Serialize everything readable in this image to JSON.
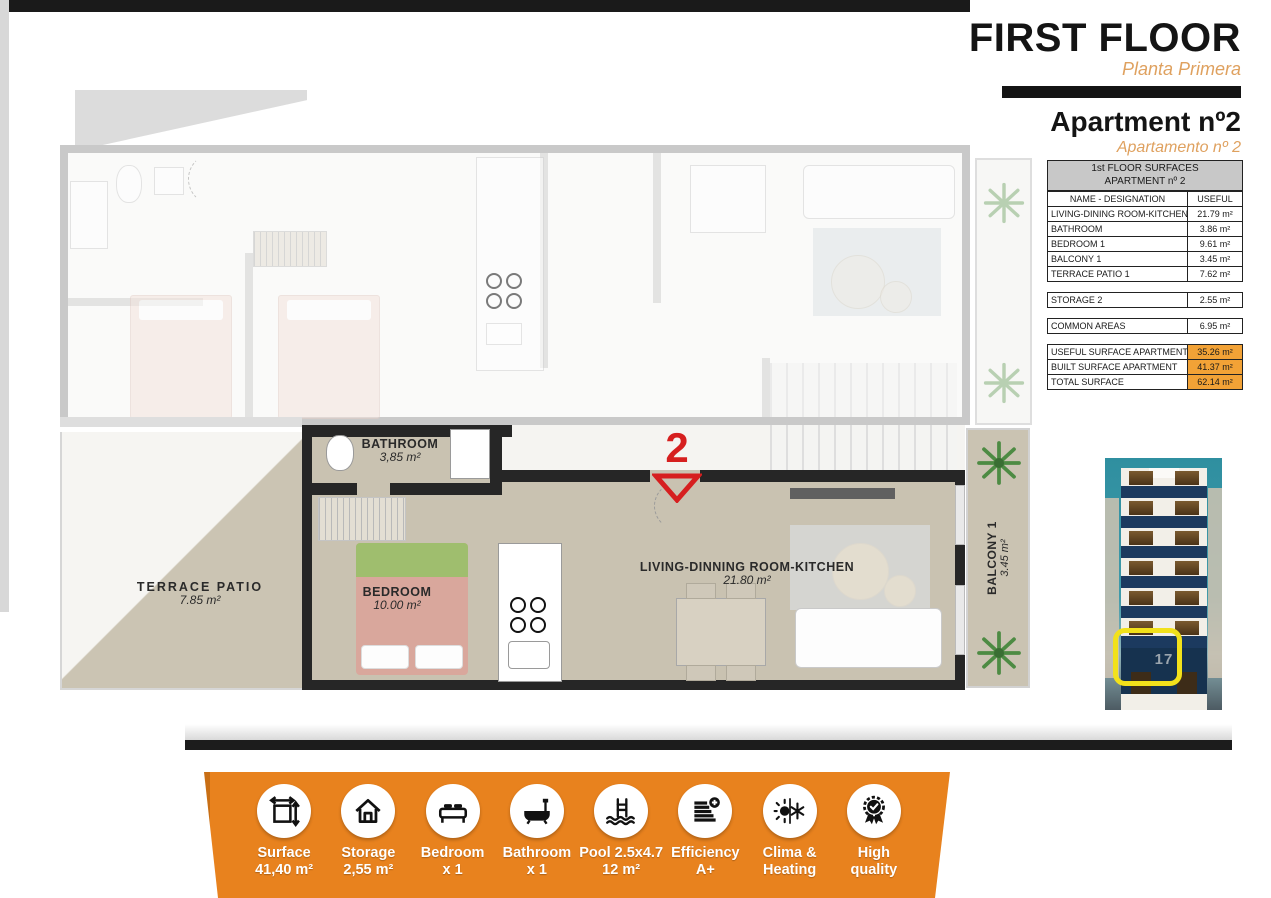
{
  "header": {
    "title": "FIRST FLOOR",
    "subtitle": "Planta Primera",
    "apartment_title": "Apartment nº2",
    "apartment_subtitle": "Apartamento nº 2"
  },
  "surfaces_table": {
    "title_line1": "1st FLOOR SURFACES",
    "title_line2": "APARTMENT nº 2",
    "col_name": "NAME - DESIGNATION",
    "col_useful": "USEFUL",
    "rows": [
      {
        "name": "LIVING-DINING ROOM-KITCHEN",
        "value": "21.79 m²"
      },
      {
        "name": "BATHROOM",
        "value": "3.86 m²"
      },
      {
        "name": "BEDROOM 1",
        "value": "9.61 m²"
      },
      {
        "name": "BALCONY 1",
        "value": "3.45 m²"
      },
      {
        "name": "TERRACE PATIO 1",
        "value": "7.62 m²"
      }
    ],
    "storage_row": {
      "name": "STORAGE 2",
      "value": "2.55 m²"
    },
    "common_row": {
      "name": "COMMON AREAS",
      "value": "6.95 m²"
    },
    "totals": [
      {
        "name": "USEFUL SURFACE APARTMENT",
        "value": "35.26 m²"
      },
      {
        "name": "BUILT SURFACE APARTMENT",
        "value": "41.37 m²"
      },
      {
        "name": "TOTAL SURFACE",
        "value": "62.14 m²"
      }
    ]
  },
  "floorplan": {
    "unit_marker": "2",
    "rooms": {
      "bathroom": {
        "name": "BATHROOM",
        "area": "3,85 m²"
      },
      "bedroom": {
        "name": "BEDROOM",
        "area": "10.00 m²"
      },
      "terrace": {
        "name": "TERRACE PATIO",
        "area": "7.85 m²"
      },
      "living": {
        "name": "LIVING-DINNING ROOM-KITCHEN",
        "area": "21.80 m²"
      },
      "balcony": {
        "name": "BALCONY 1",
        "area": "3.45 m²"
      }
    }
  },
  "building_render": {
    "street_number": "17"
  },
  "features": [
    {
      "icon": "dimensions-icon",
      "line1": "Surface",
      "line2": "41,40 m²"
    },
    {
      "icon": "house-icon",
      "line1": "Storage",
      "line2": "2,55 m²"
    },
    {
      "icon": "bed-icon",
      "line1": "Bedroom",
      "line2": "x 1"
    },
    {
      "icon": "bathtub-icon",
      "line1": "Bathroom",
      "line2": "x 1"
    },
    {
      "icon": "pool-icon",
      "line1": "Pool 2.5x4.7",
      "line2": "12 m²"
    },
    {
      "icon": "efficiency-icon",
      "line1": "Efficiency",
      "line2": "A+"
    },
    {
      "icon": "climate-icon",
      "line1": "Clima &",
      "line2": "Heating"
    },
    {
      "icon": "quality-icon",
      "line1": "High",
      "line2": "quality"
    }
  ],
  "colors": {
    "accent_orange": "#e8821e",
    "table_orange": "#f2a236",
    "subtitle_orange": "#dfa15f",
    "marker_red": "#d61f1f",
    "wall_black": "#262626",
    "wall_gray": "#c9c9c9",
    "floor_beige": "#c9c2b1",
    "sky_teal": "#2f8fa0",
    "balcony_blue": "#1c3a5f",
    "highlight_yellow": "#f2e11b"
  }
}
